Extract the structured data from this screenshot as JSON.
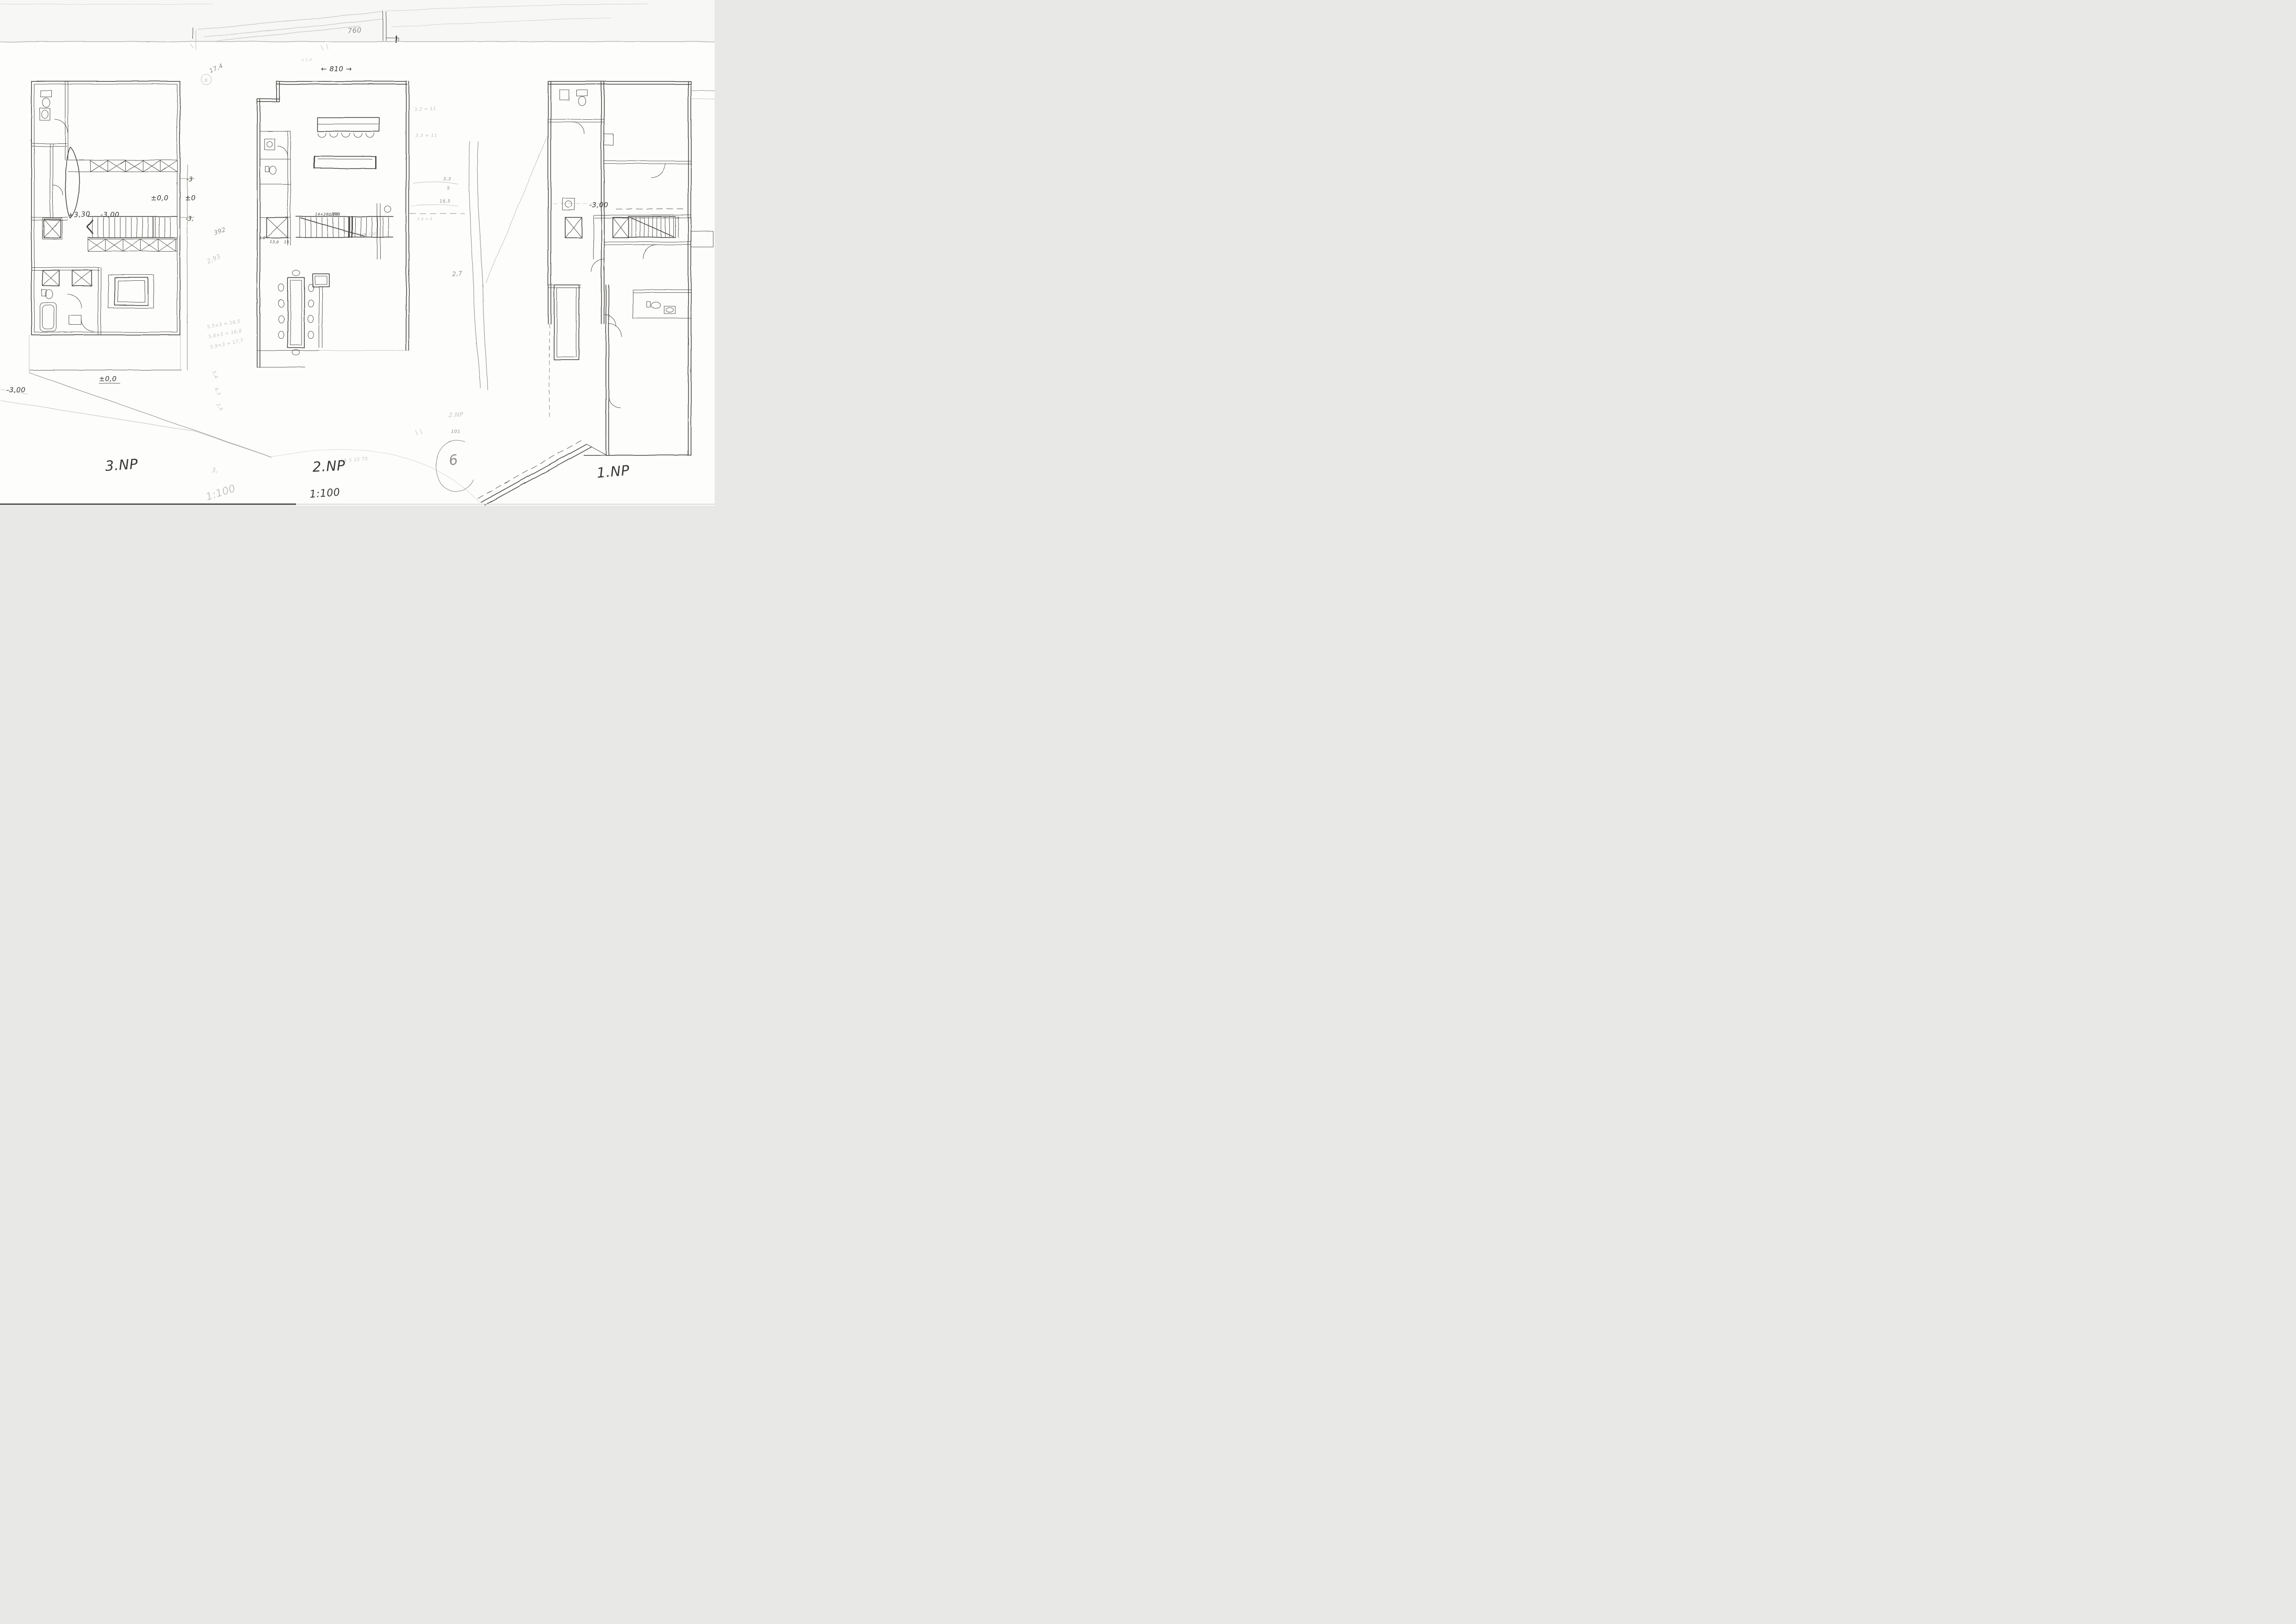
{
  "sheet": {
    "kind": "scanned hand-drawn floor plan sketch",
    "paper_color": "#fdfdfb",
    "ink_color": "#3f3d3a",
    "pencil_color": "#908e8a",
    "scale_center": "1:100",
    "scale_left": "1:100",
    "scale_left_prefix": "3,"
  },
  "plans": [
    {
      "id": "3np",
      "label": "3.NP",
      "annotations": {
        "level_main": "±0,0",
        "level_right_top": "-3",
        "level_right_mid": "±0",
        "level_right_bottom": "-3,",
        "stair_up": "+3,30",
        "stair_down": "-3,00",
        "ground": "±0,0",
        "site": "-3,00"
      }
    },
    {
      "id": "2np",
      "label": "2.NP",
      "annotations": {
        "width": "← 810 →",
        "top_small": "x 1,0",
        "stair_formula": "14×280/183",
        "stair_run": "392",
        "stair_width": "180",
        "landing": "50",
        "dim_a": "5,0",
        "dim_b": "13,0",
        "dim_c": "15",
        "ratio_top": "3,2 ≈ 11",
        "ratio_mid": "3,3 ≈ 11",
        "col_a": "3,3",
        "col_b": "5",
        "col_c": "16,5",
        "room": "2,7",
        "calc": "2,4 ≈ 8",
        "scribble": "15 5 15 75"
      }
    },
    {
      "id": "1np",
      "label": "1.NP",
      "annotations": {
        "level": "-3,00"
      }
    }
  ],
  "margin_notes": {
    "top_dim": "760",
    "area": "17,4",
    "circled": "B",
    "run": "392",
    "rise": "2,93",
    "calc1": "5,5×3 = 16,5",
    "calc2": "5,6×3 = 16,8",
    "calc3": "5,9×3 = 17,7",
    "v1": "5,4",
    "v2": "6,3",
    "v3": "2,6",
    "faint_floor": "2.NP",
    "faint_num": "101",
    "circled_num": "6"
  }
}
